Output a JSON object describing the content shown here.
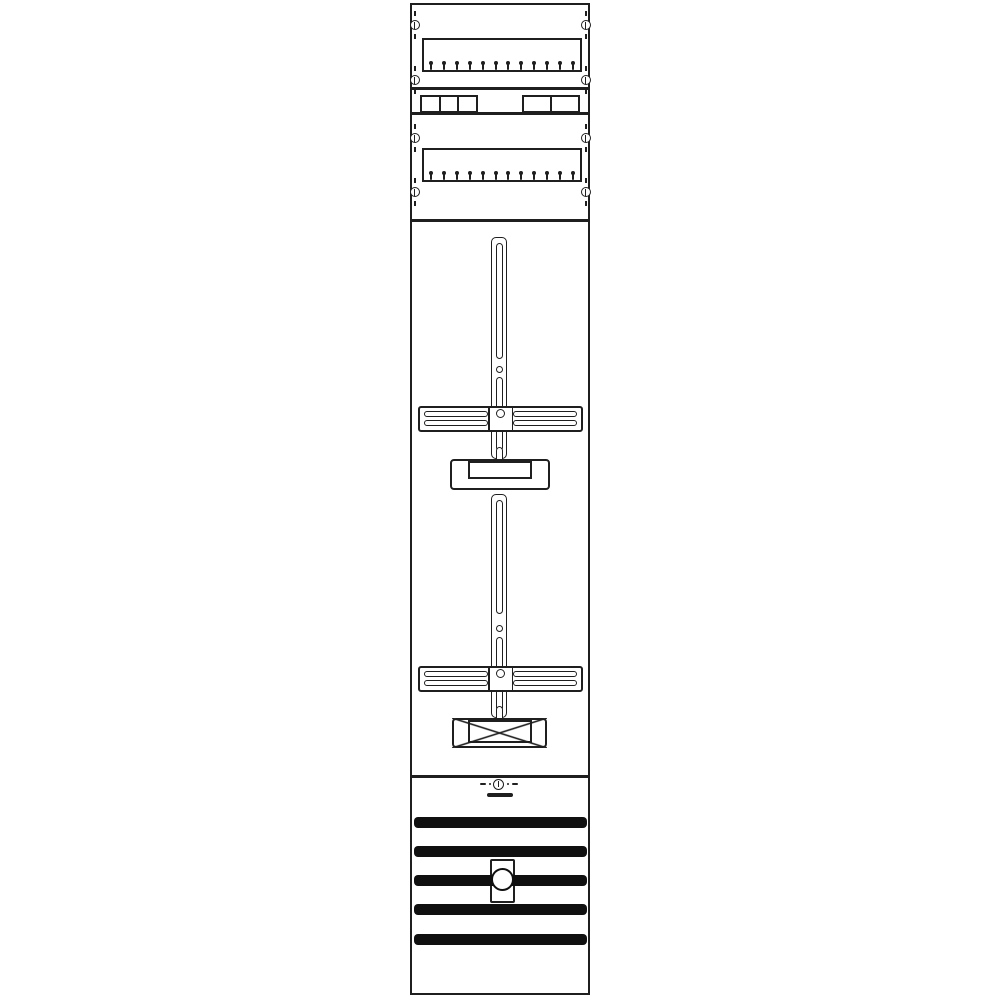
{
  "drawing": {
    "type": "technical-line-drawing",
    "subject": "meter-panel-front-view-two-meter-positions",
    "background": "#ffffff",
    "line_color": "#1f1f1f",
    "fill_color": "#101010"
  },
  "panel": {
    "x": 410,
    "y": 3,
    "width": 180,
    "height": 992
  },
  "screws": {
    "columns_x": [
      414.5,
      585.5
    ],
    "rows_y": [
      25,
      80,
      138,
      192
    ]
  },
  "din_rails": [
    {
      "x": 422,
      "y": 38,
      "width": 160,
      "height": 34,
      "tick_count": 12
    },
    {
      "x": 422,
      "y": 148,
      "width": 160,
      "height": 34,
      "tick_count": 12
    }
  ],
  "device_groups": [
    {
      "x": 420,
      "y": 95,
      "width": 58,
      "height": 18,
      "cells": 3
    },
    {
      "x": 522,
      "y": 95,
      "width": 58,
      "height": 18,
      "cells": 2
    }
  ],
  "divider_lines_y": [
    88,
    113,
    220,
    776
  ],
  "crossbar_slots": {
    "left_x": 424,
    "right_x": 513,
    "width": 64,
    "height": 6,
    "top_offset": 5,
    "bottom_offset": 14
  },
  "meter_fields": [
    {
      "rail": {
        "x": 491,
        "y": 237,
        "width": 16,
        "height": 222
      },
      "rail_slots": [
        {
          "y": 243,
          "height": 116
        },
        {
          "y": 377,
          "height": 74
        }
      ],
      "rail_hole_y": 369,
      "rail_notch_y": 447,
      "crossbar": {
        "x": 418,
        "y": 406,
        "width": 165,
        "height": 26
      },
      "crossbar_hole_y": 413,
      "box": {
        "x": 450,
        "y": 459,
        "width": 100,
        "height": 31,
        "crossed": false,
        "inner": {
          "x": 468,
          "y": 461,
          "width": 64,
          "height": 18
        }
      }
    },
    {
      "rail": {
        "x": 491,
        "y": 494,
        "width": 16,
        "height": 224
      },
      "rail_slots": [
        {
          "y": 500,
          "height": 114
        },
        {
          "y": 637,
          "height": 74
        }
      ],
      "rail_hole_y": 628,
      "rail_notch_y": 706,
      "crossbar": {
        "x": 418,
        "y": 666,
        "width": 165,
        "height": 26
      },
      "crossbar_hole_y": 673,
      "box": {
        "x": 452,
        "y": 718,
        "width": 95,
        "height": 30,
        "crossed": true,
        "inner": {
          "x": 468,
          "y": 720,
          "width": 64,
          "height": 23
        }
      }
    }
  ],
  "bottom_section": {
    "center_mark": {
      "x": 498.5,
      "y": 784,
      "bar": {
        "x": 487,
        "y": 793,
        "width": 26,
        "height": 4
      }
    },
    "bars": {
      "x": 414,
      "width": 173,
      "height": 11,
      "ys": [
        817,
        846,
        875,
        904,
        934
      ]
    },
    "clamp": {
      "x": 490,
      "y": 859,
      "width": 25,
      "height": 44,
      "circle_d": 23,
      "circle_cy": 879
    }
  }
}
